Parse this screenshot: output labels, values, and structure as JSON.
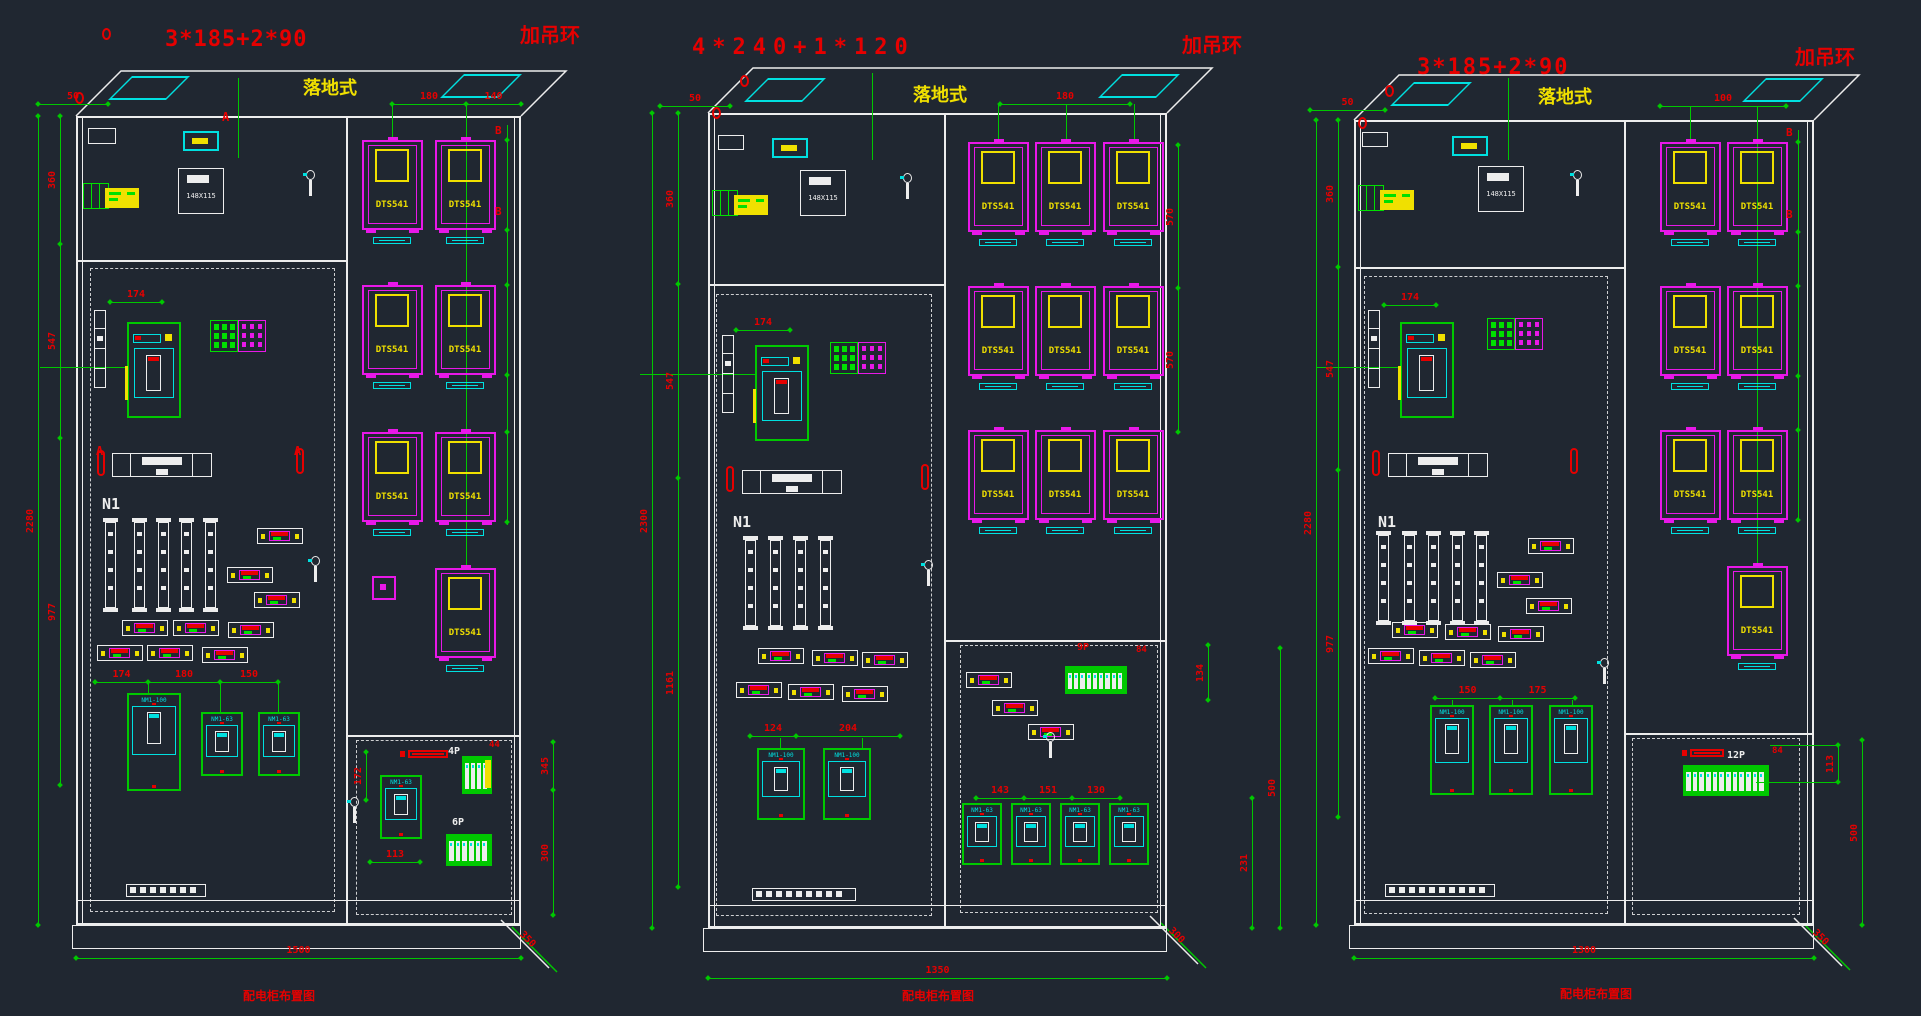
{
  "app": {
    "background": "#202731"
  },
  "colors": {
    "white": "#ededed",
    "green": "#00c800",
    "red": "#e60000",
    "magenta": "#e818e8",
    "yellow": "#f0e000",
    "cyan": "#00e0e0"
  },
  "cabinets": [
    {
      "cable_spec": "3*185+2*90",
      "hoist_note": "加吊环",
      "mount_type": "落地式",
      "bottom_note": "配电柜布置图",
      "meter_model": "DTS541",
      "meter_rows": [
        2,
        2,
        2,
        1
      ],
      "neutral_label": "N1",
      "nameplate_text": "148X115",
      "breaker_models": {
        "main": "NM1-100",
        "branch": "NM1-63"
      },
      "group_labels": [
        "4P",
        "6P"
      ],
      "section_markers": [
        "A",
        "B"
      ],
      "dims": {
        "total_height": "2280",
        "height_segments": [
          "360",
          "547",
          "977"
        ],
        "bottom_width": "1500",
        "depth": "350",
        "top_left_gap": "50",
        "meter_top": [
          "180",
          "140"
        ],
        "breaker_spacing": [
          "174",
          "180",
          "150"
        ],
        "upper_spacing": "174",
        "din_top": "44",
        "inner": [
          "172",
          "113"
        ],
        "right_side": [
          "345",
          "300"
        ]
      }
    },
    {
      "cable_spec": "4*240+1*120",
      "hoist_note": "加吊环",
      "mount_type": "落地式",
      "bottom_note": "配电柜布置图",
      "meter_model": "DTS541",
      "meter_rows": [
        3,
        3,
        3
      ],
      "neutral_label": "N1",
      "nameplate_text": "148X115",
      "breaker_models": {
        "main": "NM1-100",
        "branch": "NM1-63"
      },
      "group_labels": [
        "9P"
      ],
      "section_markers": [],
      "dims": {
        "total_height": "2300",
        "height_segments": [
          "360",
          "547",
          "1161"
        ],
        "bottom_width": "1350",
        "depth": "300",
        "top_left_gap": "50",
        "meter_top": [
          "180"
        ],
        "meter_side": [
          "570",
          "570"
        ],
        "breaker_spacing": [
          "143",
          "151",
          "130"
        ],
        "lower_spacing": [
          "124",
          "204"
        ],
        "upper_spacing": "174",
        "din_top": "84",
        "din_side": "134",
        "right_side": [
          "500",
          "231"
        ]
      }
    },
    {
      "cable_spec": "3*185+2*90",
      "hoist_note": "加吊环",
      "mount_type": "落地式",
      "bottom_note": "配电柜布置图",
      "meter_model": "DTS541",
      "meter_rows": [
        2,
        2,
        2,
        1
      ],
      "neutral_label": "N1",
      "nameplate_text": "148X115",
      "breaker_models": {
        "main": "NM1-100",
        "branch": "NM1-63"
      },
      "group_labels": [
        "12P"
      ],
      "section_markers": [
        "B"
      ],
      "dims": {
        "total_height": "2280",
        "height_segments": [
          "360",
          "547",
          "977"
        ],
        "bottom_width": "1300",
        "depth": "350",
        "top_left_gap": "50",
        "meter_top": [
          "100"
        ],
        "breaker_spacing": [
          "150",
          "175"
        ],
        "upper_spacing": "174",
        "din_top": "84",
        "din_side": "113",
        "right_side": [
          "500"
        ]
      }
    }
  ]
}
